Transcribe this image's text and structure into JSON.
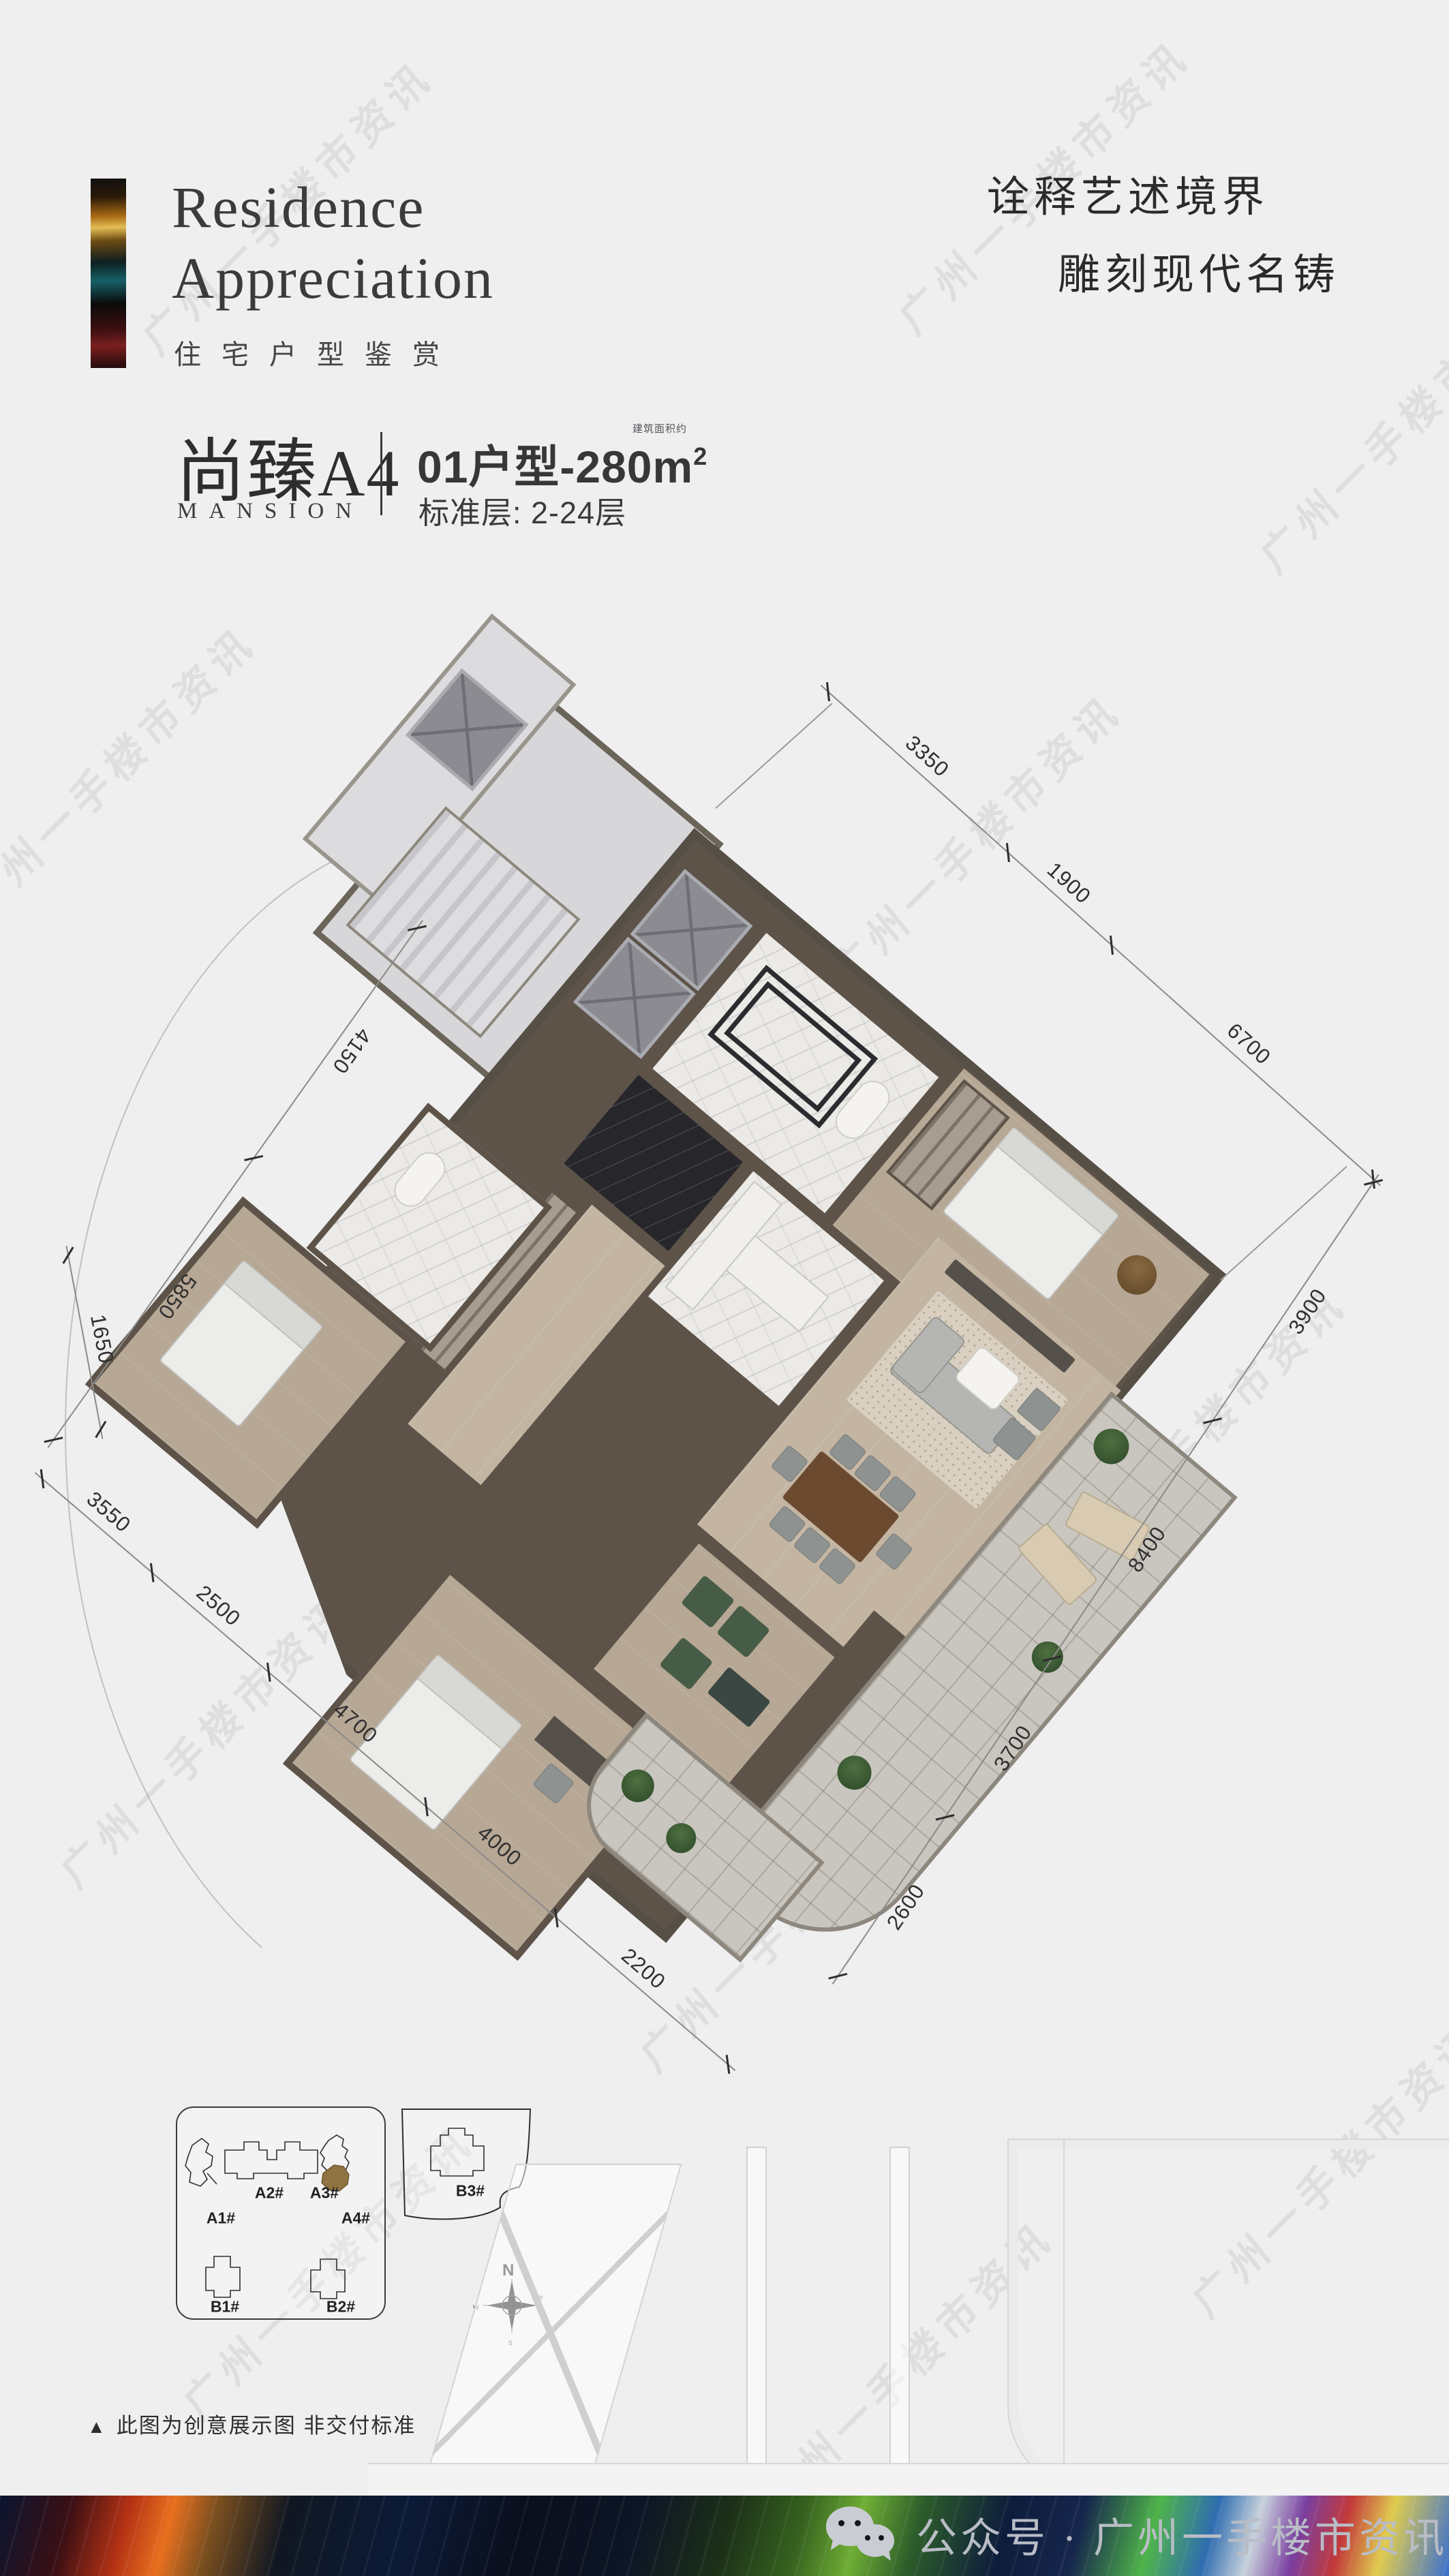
{
  "header": {
    "title_line1": "Residence",
    "title_line2": "Appreciation",
    "subtitle_cn": "住宅户型鉴赏",
    "slogan_line1": "诠释艺述境界",
    "slogan_line2": "雕刻现代名铸"
  },
  "unit": {
    "name_cn": "尚臻",
    "code": "A4",
    "name_en": "MANSION",
    "type_prefix": "01户型-280m",
    "area_note": "建筑面积约",
    "area_sup": "2",
    "floors_label": "标准层: 2-24层"
  },
  "plan": {
    "dims_top_right": [
      "3350",
      "1900",
      "6700"
    ],
    "dims_bottom_right": [
      "3900",
      "8400",
      "3700",
      "2600"
    ],
    "dims_top_left": [
      "4150",
      "5850"
    ],
    "dim_left_short": "1650",
    "dims_bottom_left": [
      "3550",
      "2500",
      "4700",
      "4000",
      "2200"
    ]
  },
  "siteplan": {
    "labels": {
      "a1": "A1#",
      "a2": "A2#",
      "a3": "A3#",
      "a4": "A4#",
      "b1": "B1#",
      "b2": "B2#",
      "b3": "B3#"
    },
    "highlight": "A4#",
    "highlight_color": "#8F7340",
    "compass": {
      "n": "N",
      "e": "e",
      "s": "s",
      "w": "w"
    }
  },
  "disclaimer": {
    "marker": "▲",
    "text": "此图为创意展示图  非交付标准"
  },
  "footer": {
    "wechat_label": "公众号 · 广州一手楼市资讯"
  },
  "watermark": {
    "text": "广州一手楼市资讯"
  },
  "colors": {
    "background": "#EFEFF0",
    "wall": "#5D5349",
    "floor": "#BCAD9B",
    "footer_text": "#B9BDC6",
    "title_text": "#3D3B3A"
  }
}
